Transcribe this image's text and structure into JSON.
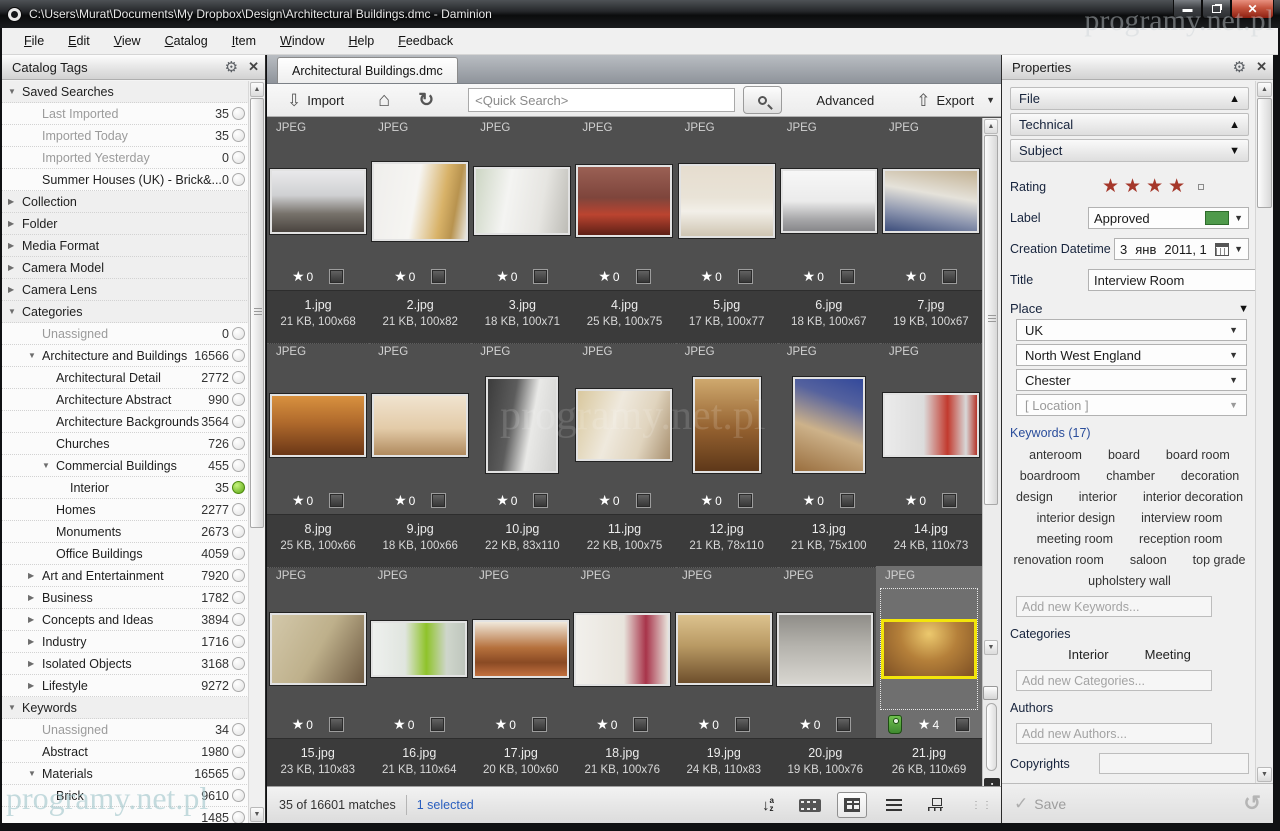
{
  "window": {
    "title": "C:\\Users\\Murat\\Documents\\My Dropbox\\Design\\Architectural Buildings.dmc - Daminion",
    "watermark": "programy.net.pl"
  },
  "menu": {
    "items": [
      "File",
      "Edit",
      "View",
      "Catalog",
      "Item",
      "Window",
      "Help",
      "Feedback"
    ]
  },
  "catalog_tags": {
    "title": "Catalog Tags",
    "items": [
      {
        "label": "Saved Searches",
        "count": "",
        "lvl": 0,
        "arrow": "open"
      },
      {
        "label": "Last Imported",
        "count": "35",
        "lvl": 1,
        "dim": true,
        "radio": "off"
      },
      {
        "label": "Imported Today",
        "count": "35",
        "lvl": 1,
        "dim": true,
        "radio": "off"
      },
      {
        "label": "Imported Yesterday",
        "count": "0",
        "lvl": 1,
        "dim": true,
        "radio": "off"
      },
      {
        "label": "Summer Houses (UK) - Brick&...",
        "count": "0",
        "lvl": 1,
        "radio": "off"
      },
      {
        "label": "Collection",
        "count": "",
        "lvl": 0,
        "arrow": "closed"
      },
      {
        "label": "Folder",
        "count": "",
        "lvl": 0,
        "arrow": "closed"
      },
      {
        "label": "Media Format",
        "count": "",
        "lvl": 0,
        "arrow": "closed"
      },
      {
        "label": "Camera Model",
        "count": "",
        "lvl": 0,
        "arrow": "closed"
      },
      {
        "label": "Camera Lens",
        "count": "",
        "lvl": 0,
        "arrow": "closed"
      },
      {
        "label": "Categories",
        "count": "",
        "lvl": 0,
        "arrow": "open"
      },
      {
        "label": "Unassigned",
        "count": "0",
        "lvl": 1,
        "dim": true,
        "radio": "off"
      },
      {
        "label": "Architecture and Buildings",
        "count": "16566",
        "lvl": 1,
        "arrow": "open",
        "radio": "off"
      },
      {
        "label": "Architectural Detail",
        "count": "2772",
        "lvl": 2,
        "radio": "off"
      },
      {
        "label": "Architecture Abstract",
        "count": "990",
        "lvl": 2,
        "radio": "off"
      },
      {
        "label": "Architecture Backgrounds",
        "count": "3564",
        "lvl": 2,
        "radio": "off"
      },
      {
        "label": "Churches",
        "count": "726",
        "lvl": 2,
        "radio": "off"
      },
      {
        "label": "Commercial Buildings",
        "count": "455",
        "lvl": 2,
        "arrow": "open",
        "radio": "off"
      },
      {
        "label": "Interior",
        "count": "35",
        "lvl": 3,
        "radio": "on"
      },
      {
        "label": "Homes",
        "count": "2277",
        "lvl": 2,
        "radio": "off"
      },
      {
        "label": "Monuments",
        "count": "2673",
        "lvl": 2,
        "radio": "off"
      },
      {
        "label": "Office Buildings",
        "count": "4059",
        "lvl": 2,
        "radio": "off"
      },
      {
        "label": "Art and Entertainment",
        "count": "7920",
        "lvl": 1,
        "arrow": "closed",
        "radio": "off"
      },
      {
        "label": "Business",
        "count": "1782",
        "lvl": 1,
        "arrow": "closed",
        "radio": "off"
      },
      {
        "label": "Concepts and Ideas",
        "count": "3894",
        "lvl": 1,
        "arrow": "closed",
        "radio": "off"
      },
      {
        "label": "Industry",
        "count": "1716",
        "lvl": 1,
        "arrow": "closed",
        "radio": "off"
      },
      {
        "label": "Isolated Objects",
        "count": "3168",
        "lvl": 1,
        "arrow": "closed",
        "radio": "off"
      },
      {
        "label": "Lifestyle",
        "count": "9272",
        "lvl": 1,
        "arrow": "closed",
        "radio": "off"
      },
      {
        "label": "Keywords",
        "count": "",
        "lvl": 0,
        "arrow": "open"
      },
      {
        "label": "Unassigned",
        "count": "34",
        "lvl": 1,
        "dim": true,
        "radio": "off"
      },
      {
        "label": "Abstract",
        "count": "1980",
        "lvl": 1,
        "radio": "off"
      },
      {
        "label": "Materials",
        "count": "16565",
        "lvl": 1,
        "arrow": "open",
        "radio": "off"
      },
      {
        "label": "Brick",
        "count": "9610",
        "lvl": 2,
        "radio": "off"
      },
      {
        "label": "",
        "count": "1485",
        "lvl": 2,
        "radio": "off"
      }
    ]
  },
  "browser": {
    "tab": "Architectural Buildings.dmc",
    "toolbar": {
      "import_label": "Import",
      "search_placeholder": "<Quick Search>",
      "advanced_label": "Advanced",
      "export_label": "Export"
    },
    "items": [
      {
        "type": "JPEG",
        "name": "1.jpg",
        "info": "21 KB, 100x68",
        "w": 100,
        "h": 68,
        "stars": "0",
        "bg": "linear-gradient(180deg,#e9e9eb 0%,#cfd0d2 40%,#77726b 70%,#4a443f 100%)"
      },
      {
        "type": "JPEG",
        "name": "2.jpg",
        "info": "21 KB, 100x82",
        "w": 100,
        "h": 82,
        "stars": "0",
        "bg": "linear-gradient(100deg,#efeeec 0%,#f6f5f2 45%,#d8b268 72%,#b8934f 85%,#e8e6e0 100%)"
      },
      {
        "type": "JPEG",
        "name": "3.jpg",
        "info": "18 KB, 100x71",
        "w": 100,
        "h": 71,
        "stars": "0",
        "bg": "linear-gradient(100deg,#cdd6c4 0%,#f4f4f2 35%,#e6e5e1 70%,#bdbcb6 100%)"
      },
      {
        "type": "JPEG",
        "name": "4.jpg",
        "info": "25 KB, 100x75",
        "w": 100,
        "h": 75,
        "stars": "0",
        "bg": "linear-gradient(180deg,#9a6054 0%,#7e453c 45%,#bb4430 70%,#5e2016 100%)"
      },
      {
        "type": "JPEG",
        "name": "5.jpg",
        "info": "17 KB, 100x77",
        "w": 100,
        "h": 77,
        "stars": "0",
        "bg": "linear-gradient(180deg,#e6ddcf 0%,#e9e3d7 45%,#f2efe8 65%,#cfc5b2 100%)"
      },
      {
        "type": "JPEG",
        "name": "6.jpg",
        "info": "18 KB, 100x67",
        "w": 100,
        "h": 67,
        "stars": "0",
        "bg": "linear-gradient(180deg,#f7f7f7 0%,#ebebeb 50%,#a8a8aa 80%,#87878a 100%)"
      },
      {
        "type": "JPEG",
        "name": "7.jpg",
        "info": "19 KB, 100x67",
        "w": 100,
        "h": 67,
        "stars": "0",
        "bg": "linear-gradient(190deg,#c3b294 0%,#e5e2da 40%,#8a93ad 72%,#3d4e7c 100%)"
      },
      {
        "type": "JPEG",
        "name": "8.jpg",
        "info": "25 KB, 100x66",
        "w": 100,
        "h": 66,
        "stars": "0",
        "bg": "linear-gradient(180deg,#d8913f 0%,#b06a2c 45%,#6b3717 100%)"
      },
      {
        "type": "JPEG",
        "name": "9.jpg",
        "info": "18 KB, 100x66",
        "w": 100,
        "h": 66,
        "stars": "0",
        "bg": "linear-gradient(180deg,#f0e3cf 0%,#e3cba8 55%,#b08a5e 100%)"
      },
      {
        "type": "JPEG",
        "name": "10.jpg",
        "info": "22 KB, 83x110",
        "w": 83,
        "h": 110,
        "stars": "0",
        "bg": "linear-gradient(100deg,#3c3c3c 0%,#5c5c5c 35%,#e9e9e7 62%,#cfcfcd 100%)"
      },
      {
        "type": "JPEG",
        "name": "11.jpg",
        "info": "22 KB, 100x75",
        "w": 100,
        "h": 75,
        "stars": "0",
        "bg": "linear-gradient(110deg,#d9c89e 0%,#efe9dd 40%,#e0d4be 70%,#a89070 100%)"
      },
      {
        "type": "JPEG",
        "name": "12.jpg",
        "info": "21 KB, 78x110",
        "w": 78,
        "h": 110,
        "stars": "0",
        "bg": "linear-gradient(180deg,#cfa96e 0%,#93602f 55%,#5e3819 100%)"
      },
      {
        "type": "JPEG",
        "name": "13.jpg",
        "info": "21 KB, 75x100",
        "w": 75,
        "h": 100,
        "stars": "0",
        "bg": "linear-gradient(200deg,#33499b 0%,#55629e 25%,#cdb28a 58%,#9a6f3f 100%)"
      },
      {
        "type": "JPEG",
        "name": "14.jpg",
        "info": "24 KB, 110x73",
        "w": 110,
        "h": 73,
        "stars": "0",
        "bg": "linear-gradient(90deg,#ebebeb 0%,#dcdcdc 42%,#c23a2e 68%,#d8d8d8 88%,#b5352a 100%)"
      },
      {
        "type": "JPEG",
        "name": "15.jpg",
        "info": "23 KB, 110x83",
        "w": 110,
        "h": 83,
        "stars": "0",
        "bg": "linear-gradient(120deg,#d3c8aa 0%,#beb08b 50%,#6e5a42 100%)"
      },
      {
        "type": "JPEG",
        "name": "16.jpg",
        "info": "21 KB, 110x64",
        "w": 110,
        "h": 64,
        "stars": "0",
        "bg": "linear-gradient(90deg,#eef0ee 0%,#e0e5df 35%,#8fc32a 58%,#cfd6cc 80%,#bfc6bd 100%)"
      },
      {
        "type": "JPEG",
        "name": "17.jpg",
        "info": "20 KB, 100x60",
        "w": 100,
        "h": 60,
        "stars": "0",
        "bg": "linear-gradient(180deg,#f0e8da 0%,#b5703c 48%,#8a4a24 75%,#c2703e 100%)"
      },
      {
        "type": "JPEG",
        "name": "18.jpg",
        "info": "21 KB, 100x76",
        "w": 100,
        "h": 76,
        "stars": "0",
        "bg": "linear-gradient(90deg,#f2f0ec 0%,#e8e4dc 52%,#a8344a 76%,#e8e4dc 100%)"
      },
      {
        "type": "JPEG",
        "name": "19.jpg",
        "info": "24 KB, 110x83",
        "w": 110,
        "h": 83,
        "stars": "0",
        "bg": "linear-gradient(180deg,#dcc28e 0%,#b99a64 45%,#6e4f2c 100%)"
      },
      {
        "type": "JPEG",
        "name": "20.jpg",
        "info": "19 KB, 100x76",
        "w": 100,
        "h": 76,
        "stars": "0",
        "bg": "linear-gradient(180deg,#8f8d88 0%,#b5b3ad 45%,#d8d6d0 100%)"
      },
      {
        "type": "JPEG",
        "name": "21.jpg",
        "info": "26 KB, 110x69",
        "w": 110,
        "h": 69,
        "stars": "4",
        "selected": true,
        "tagged": true,
        "bg": "radial-gradient(ellipse at 50% 22%, #ecc96e 0%, #b5803a 45%, #7e5024 100%)"
      }
    ],
    "status": {
      "matches": "35 of 16601 matches",
      "selected": "1 selected"
    }
  },
  "properties": {
    "title": "Properties",
    "sections": {
      "file": "File",
      "technical": "Technical",
      "subject": "Subject"
    },
    "fields": {
      "rating_label": "Rating",
      "label_label": "Label",
      "label_value": "Approved",
      "datetime_label": "Creation Datetime",
      "datetime_day": "3",
      "datetime_month": "янв",
      "datetime_rest": "2011, 1",
      "title_label": "Title",
      "title_value": "Interview Room",
      "place_label": "Place",
      "place_values": [
        {
          "value": "UK"
        },
        {
          "value": "North West England"
        },
        {
          "value": "Chester"
        },
        {
          "value": "[ Location ]",
          "dim": true
        }
      ],
      "keywords_label": "Keywords (17)",
      "keywords": [
        "anteroom",
        "board",
        "board room",
        "boardroom",
        "chamber",
        "decoration",
        "design",
        "interior",
        "interior decoration",
        "interior design",
        "interview room",
        "meeting room",
        "reception room",
        "renovation room",
        "saloon",
        "top grade",
        "upholstery wall"
      ],
      "add_keywords_placeholder": "Add new Keywords...",
      "categories_label": "Categories",
      "categories": [
        "Interior",
        "Meeting"
      ],
      "add_categories_placeholder": "Add new Categories...",
      "authors_label": "Authors",
      "add_authors_placeholder": "Add new Authors...",
      "copyrights_label": "Copyrights",
      "people_label": "People",
      "add_people_placeholder": "Add new People...",
      "description_label": "Description"
    },
    "save_label": "Save"
  }
}
